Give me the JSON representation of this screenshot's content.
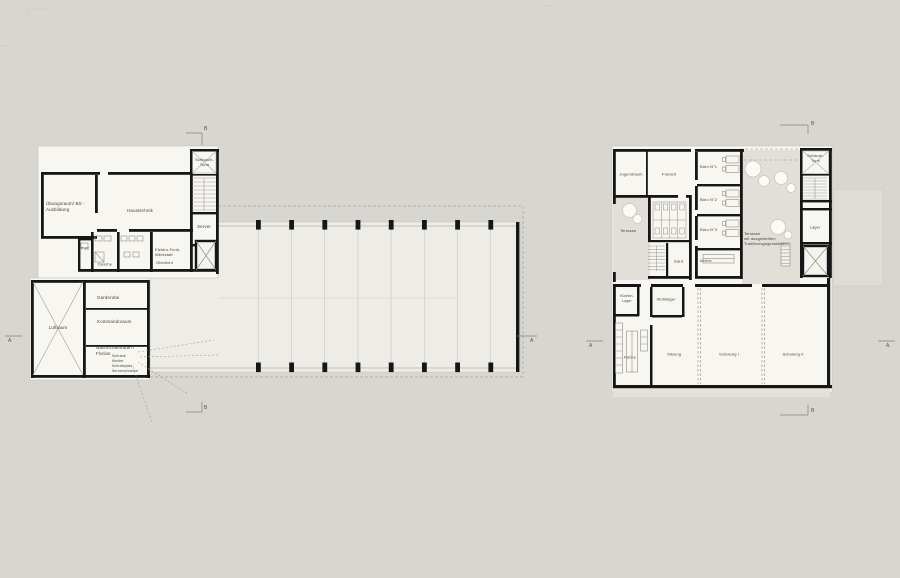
{
  "palette": {
    "background": "#d8d6d0",
    "room_fill": "#f7f6f1",
    "hall_fill": "#edece6",
    "terrace_fill": "#e1dfd8",
    "wall": "#161616"
  },
  "markers": {
    "a": "A",
    "b": "B"
  },
  "left_plan": {
    "rooms": {
      "uebungsraum": "Übungsraum/ BS -\nAusbildung",
      "haustechnik": "Haustechnik",
      "schlauch_turm": "Schlauch-\nTurm",
      "server": "Server",
      "putz": "Putz",
      "dusche": "Dusche",
      "elektro_werkstatt": "Elektro-Funk-\nWerkstatt",
      "oberlicht": "Oberlicht",
      "luftraum": "Luftraum",
      "garderobe": "Garderobe",
      "kommandoraum": "Kommandoraum",
      "nachrichtenraum": "Nachrichtenraum /\nFlorian",
      "nachrichten_details": "Schrank\nKleider\nSchreibplatz\nServerschränke"
    }
  },
  "right_plan": {
    "rooms": {
      "jugendraum": "Jugendraum",
      "freizeit": "Freizeit",
      "buero_1": "Büro N°1",
      "buero_2": "Büro N°2",
      "buero_3": "Büro N°3",
      "terrasse": "Terrasse",
      "gard": "Gard.",
      "archiv": "Archiv",
      "terrasse_mitte": "Terrasse\nmit ausgestellten\nTraditionsgegenständen",
      "schlauch_turm": "Schlauch-\nTurm",
      "lager": "Lager",
      "kuechen_lager": "Küchen-\nLager",
      "stuhllager": "Stuhllager",
      "kueche": "Küche",
      "sitzung": "Sitzung",
      "schulung_1": "Schulung I",
      "schulung_2": "Schulung II"
    }
  }
}
